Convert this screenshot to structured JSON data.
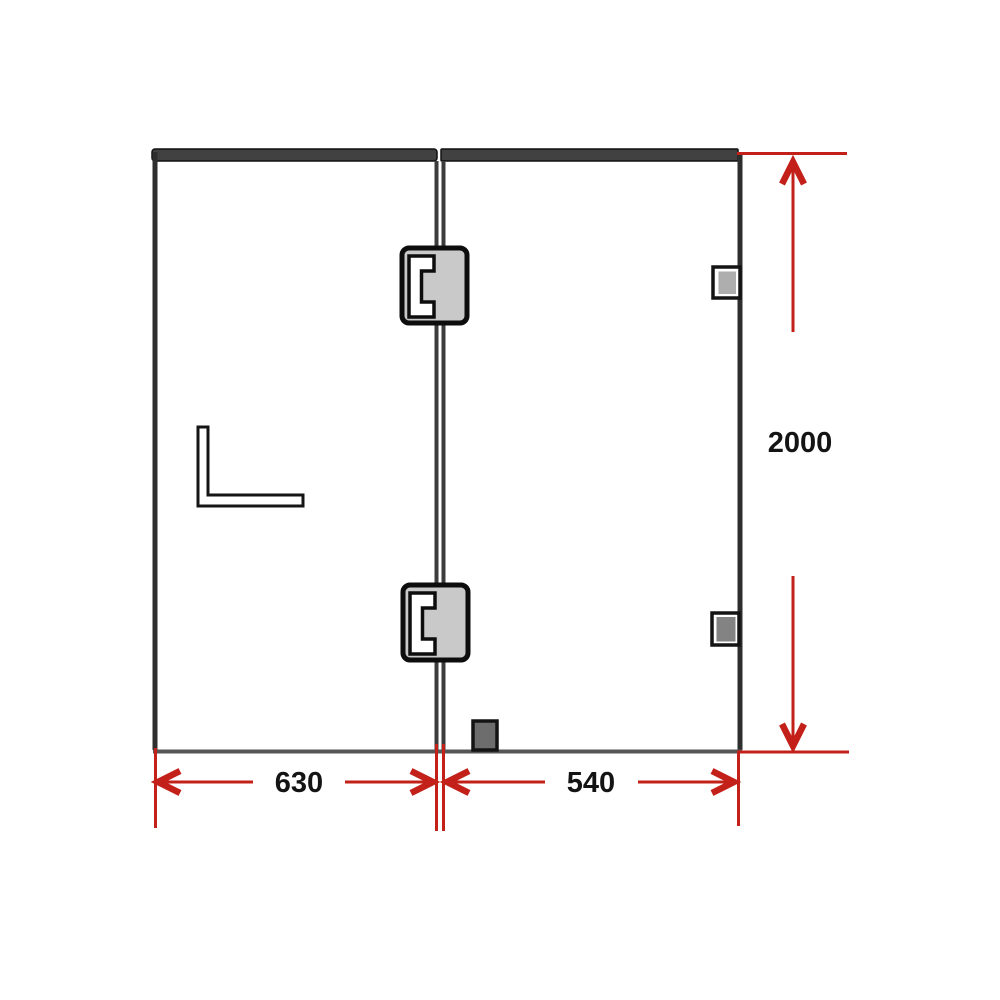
{
  "diagram": {
    "kind": "technical-drawing",
    "dimensions": {
      "left_panel_width": "630",
      "right_panel_width": "540",
      "overall_height": "2000"
    },
    "components": [
      {
        "name": "left-glass-panel"
      },
      {
        "name": "right-glass-panel"
      },
      {
        "name": "top-rail"
      },
      {
        "name": "glass-hinge-top-icon"
      },
      {
        "name": "glass-hinge-bottom-icon"
      },
      {
        "name": "wall-bracket-upper-icon"
      },
      {
        "name": "wall-bracket-lower-icon"
      },
      {
        "name": "floor-bracket-icon"
      },
      {
        "name": "l-bracket-icon"
      }
    ]
  },
  "colors": {
    "background": "#ffffff",
    "dimension_red": "#c32019",
    "frame_gray": "#414141",
    "edge_dark": "#2e2e2e",
    "divider_gray": "#3c3c3c",
    "bottom_gray": "#565656",
    "hinge_fill": "#c9c9c9",
    "hinge_outline": "#0d0d0d",
    "bracket_light": "#aeaeae",
    "bracket_mid": "#838383",
    "bracket_dark": "#6d6d6d",
    "label_ink": "#141414"
  }
}
